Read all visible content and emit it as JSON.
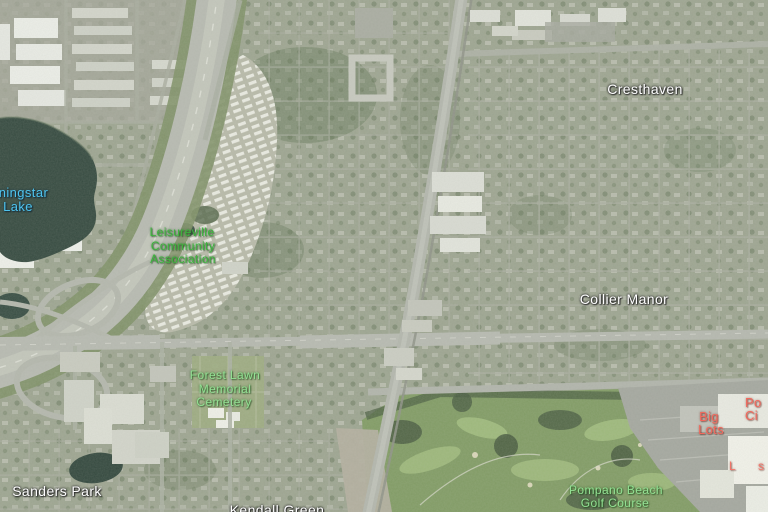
{
  "map": {
    "view": "satellite-with-labels",
    "labels": {
      "cresthaven": "Cresthaven",
      "collier_manor": "Collier Manor",
      "sanders_park": "Sanders Park",
      "kendall_green": "Kendall Green",
      "lake_line1": "rningstar",
      "lake_line2": "Lake",
      "leisureville_line1": "Leisureville",
      "leisureville_line2": "Community",
      "leisureville_line3": "Association",
      "cemetery_line1": "Forest Lawn",
      "cemetery_line2": "Memorial",
      "cemetery_line3": "Cemetery",
      "golf_line1": "Pompano Beach",
      "golf_line2": "Golf Course",
      "store_line1": "Big",
      "store_line2": "Lots",
      "edge_poi_line1": "Po",
      "edge_poi_line2": "Ci",
      "mall_poi_frag1": "L",
      "mall_poi_frag2": "s"
    },
    "label_colors": {
      "neighborhood": "#ffffff",
      "water": "#4fc4ee",
      "community_green": "#3cb53c",
      "park_green": "#93e093",
      "poi_red": "#f2685c"
    }
  }
}
